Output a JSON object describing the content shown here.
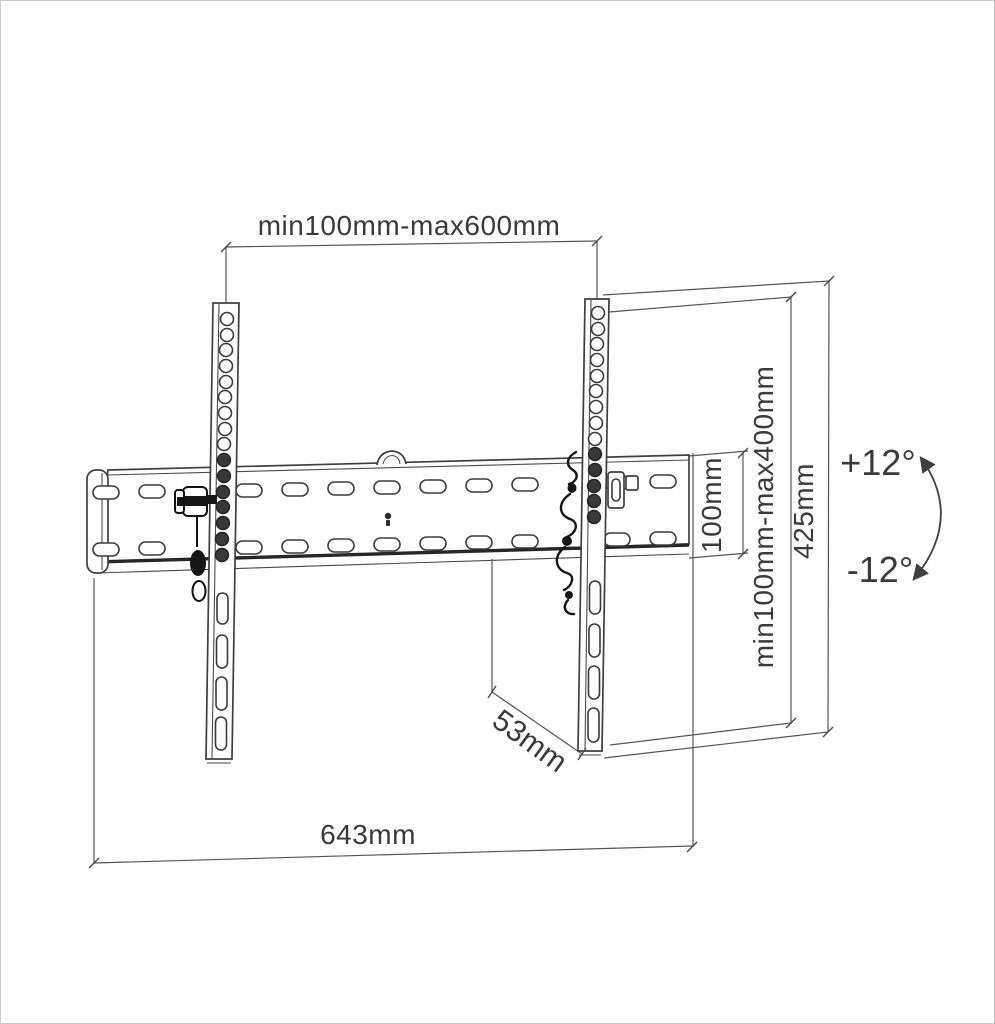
{
  "figure": {
    "type": "technical-diagram",
    "subject": "tilting TV wall-mount bracket with dimensions",
    "labels": {
      "rail_span_horizontal": "min100mm-max600mm",
      "vesa_vertical_range": "min100mm-max400mm",
      "bracket_total_height": "425mm",
      "wall_plate_height": "100mm",
      "bracket_depth": "53mm",
      "wall_plate_width": "643mm",
      "tilt_angle_up": "+12°",
      "tilt_angle_down": "-12°"
    },
    "colors": {
      "background": "#ffffff",
      "outline": "#3f3f3f",
      "dimension_line": "#555555",
      "text": "#3a3a3a",
      "hardware_dark": "#161616",
      "border": "#c9c9c9"
    }
  }
}
